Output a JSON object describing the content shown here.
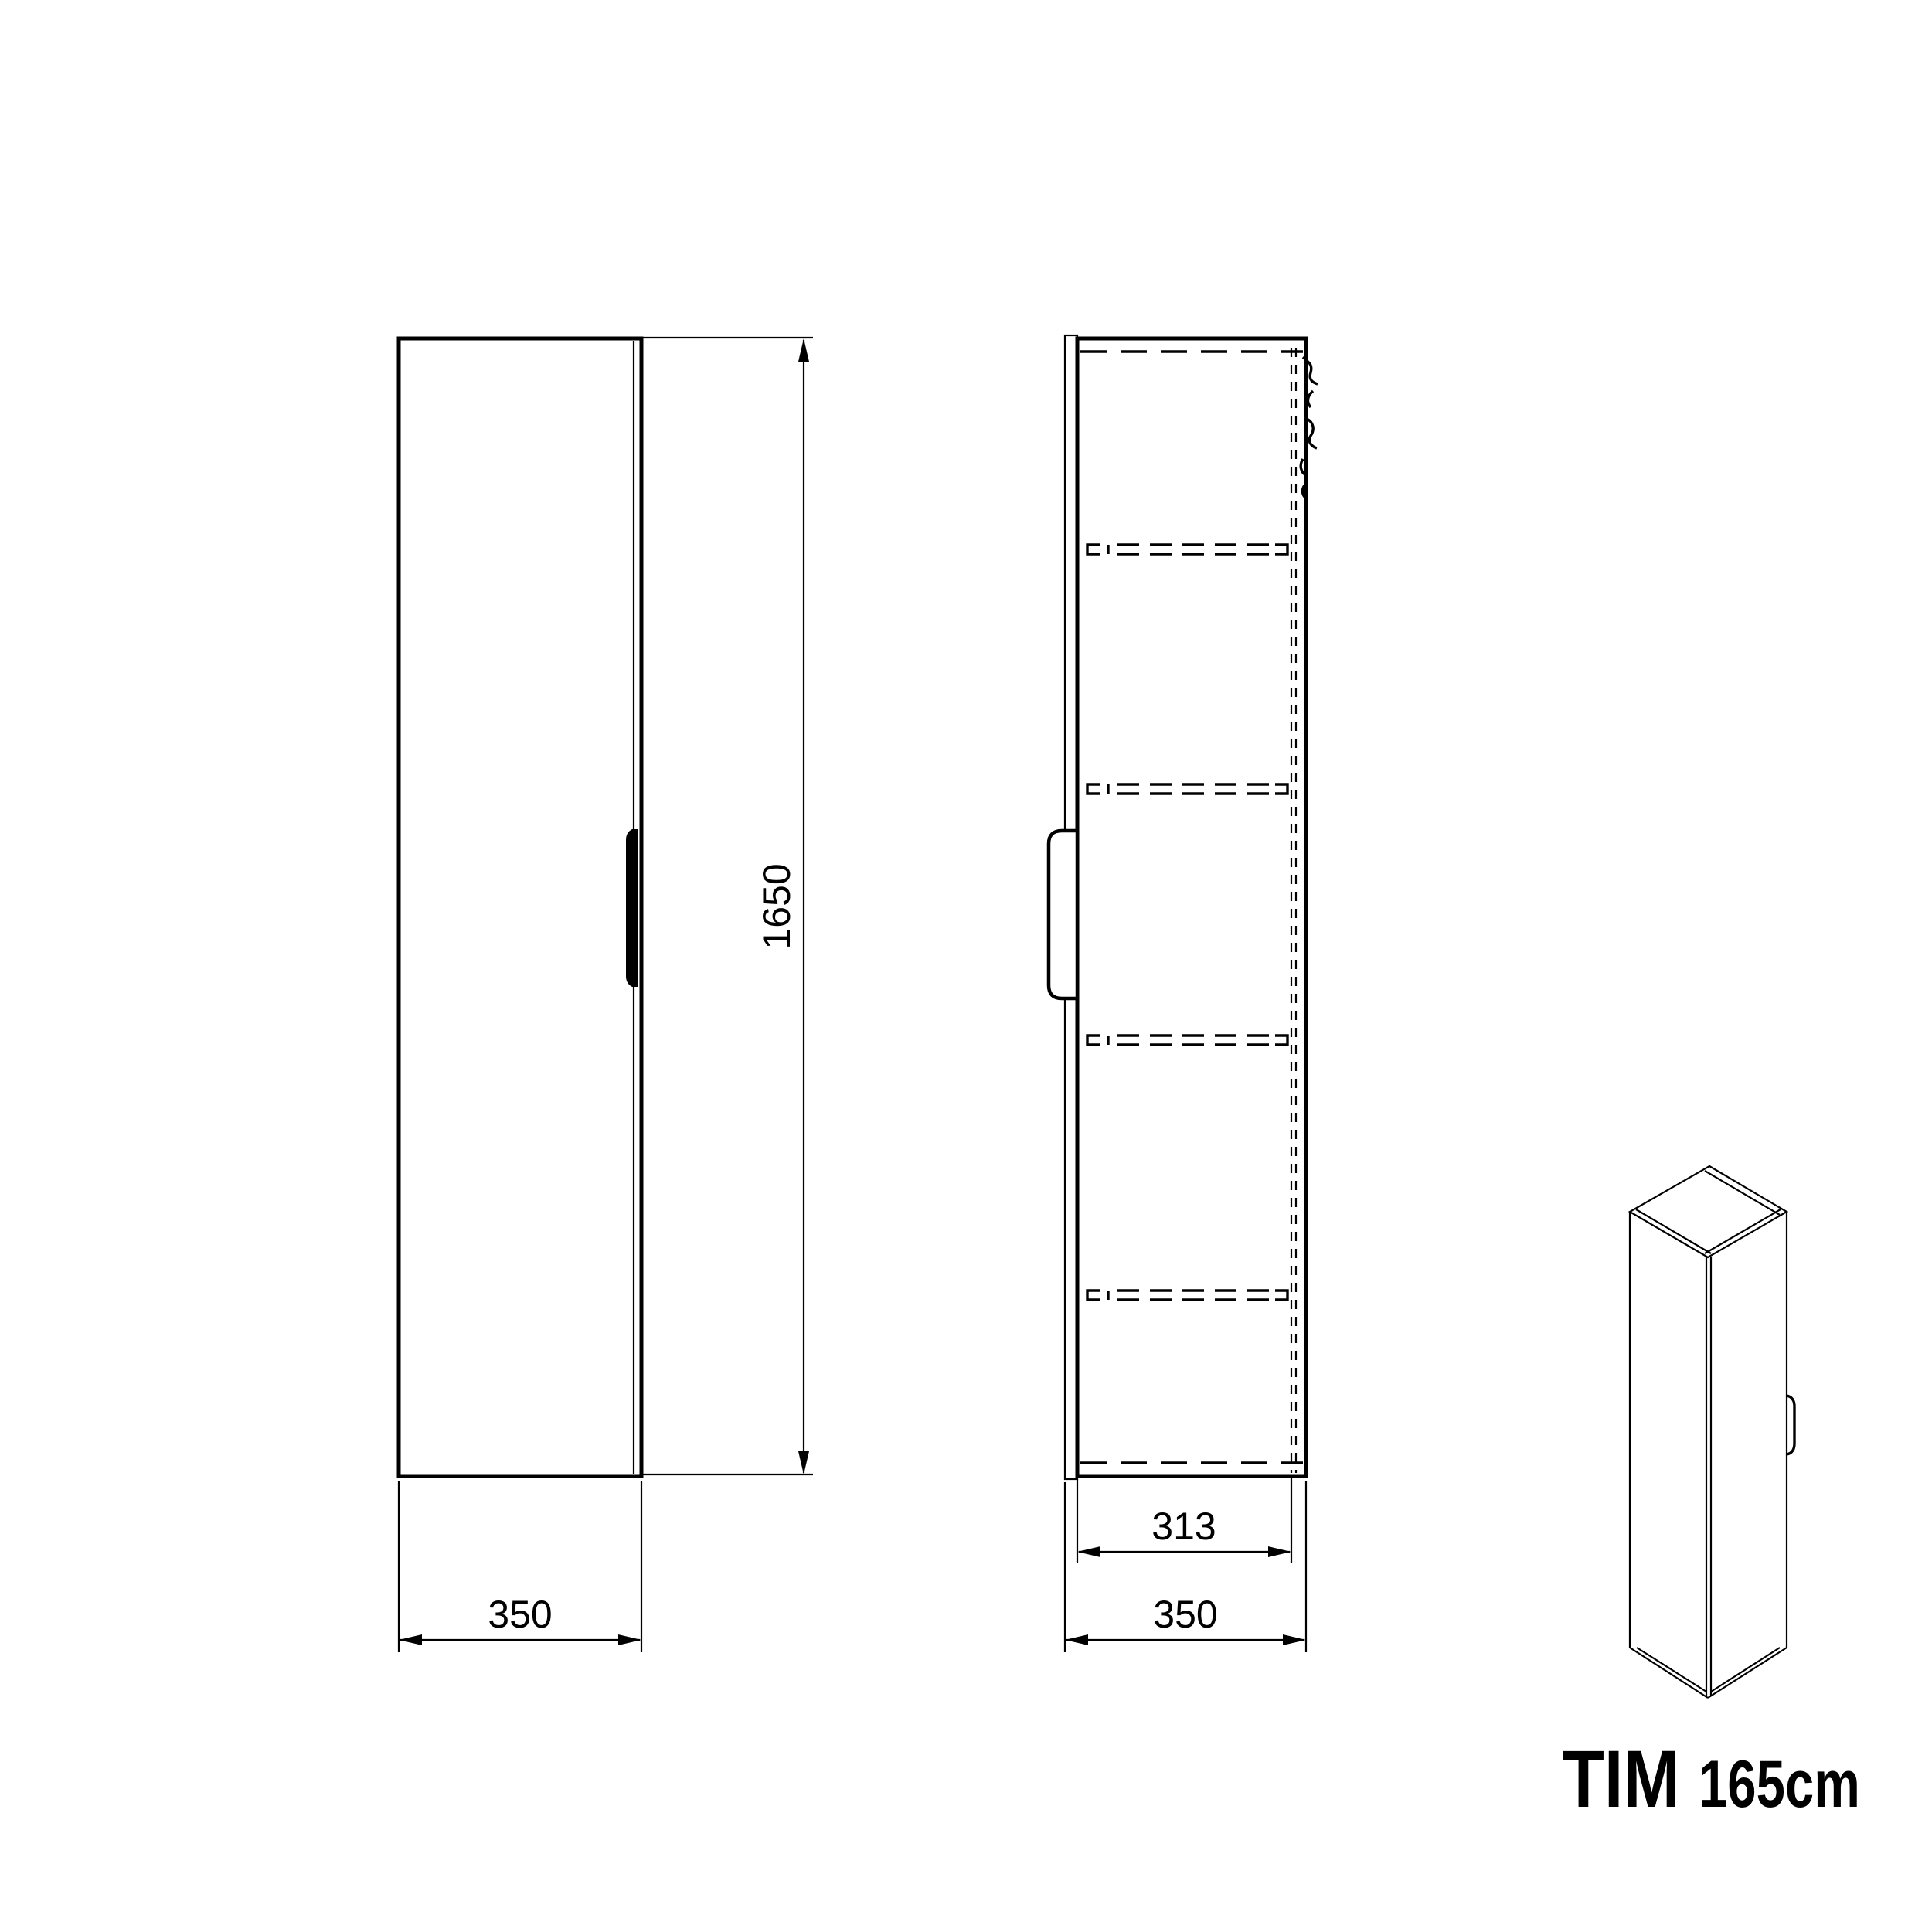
{
  "product": {
    "name": "TIM",
    "size": "165cm"
  },
  "views": {
    "front": {
      "height_dim": "1650",
      "width_dim": "350"
    },
    "side": {
      "inner_depth_dim": "313",
      "depth_dim": "350",
      "shelf_count": 4
    }
  },
  "colors": {
    "line": "#000000",
    "background": "#ffffff"
  }
}
